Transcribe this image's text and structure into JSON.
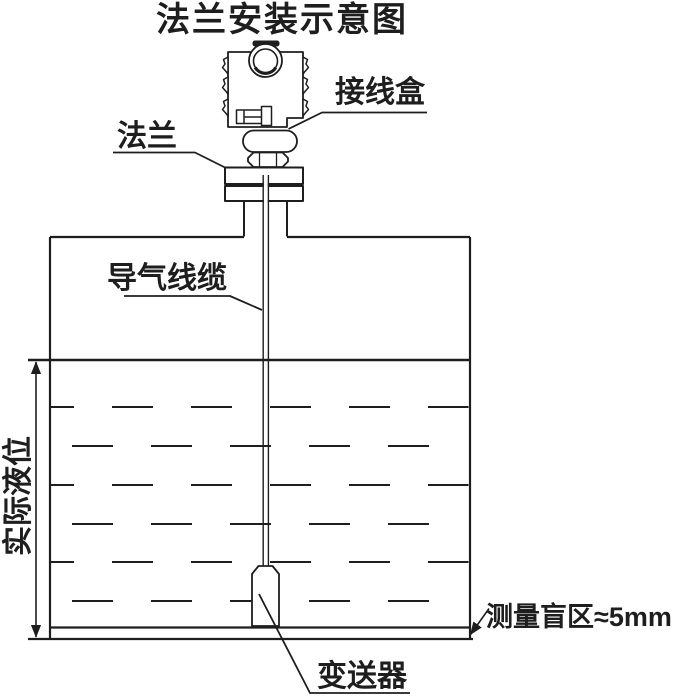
{
  "title": "法兰安装示意图",
  "labels": {
    "junction_box": "接线盒",
    "flange": "法兰",
    "air_cable": "导气线缆",
    "actual_level": "实际液位",
    "transmitter": "变送器",
    "blind_zone": "测量盲区≈5mm"
  },
  "colors": {
    "line": "#1e1e1e",
    "background": "#ffffff"
  }
}
